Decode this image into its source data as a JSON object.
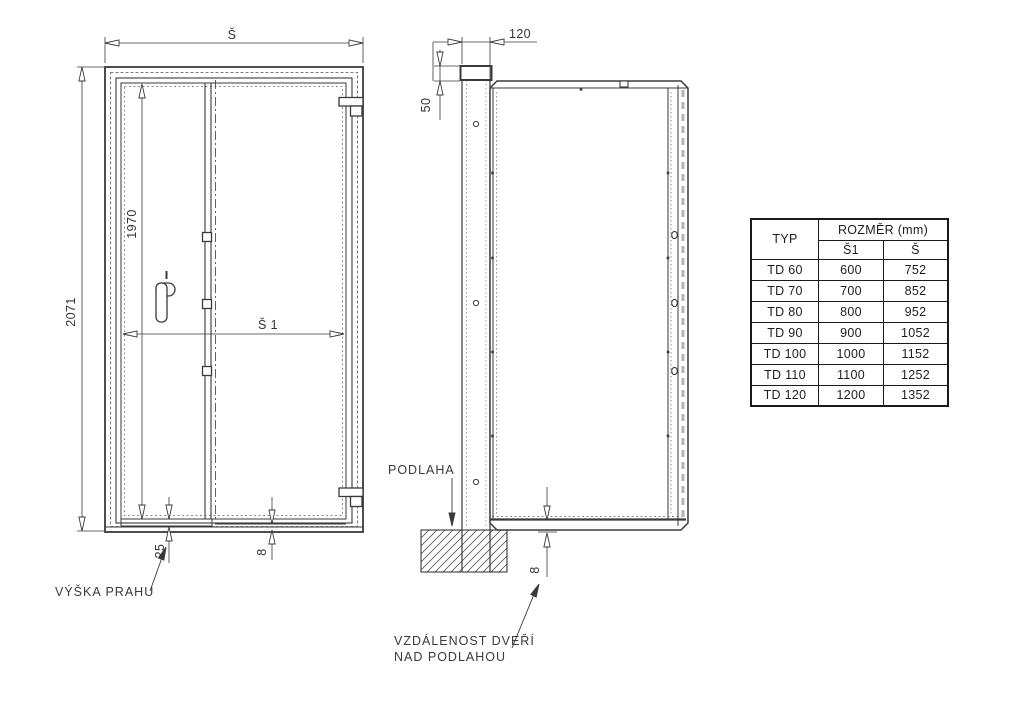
{
  "front_view": {
    "width_dim": "Š",
    "height_dim": "2071",
    "opening_height_dim": "1970",
    "opening_width_dim": "Š 1",
    "threshold_dim": "25",
    "bottom_gap_dim": "8",
    "threshold_label": "VÝŠKA PRAHU"
  },
  "side_view": {
    "frame_depth_dim": "120",
    "top_offset_dim": "50",
    "floor_gap_dim": "8",
    "floor_label": "PODLAHA",
    "gap_note_line1": "VZDÁLENOST DVEŘÍ",
    "gap_note_line2": "NAD PODLAHOU"
  },
  "size_table": {
    "col_type": "TYP",
    "col_dimension": "ROZMĚR (mm)",
    "col_s1": "Š1",
    "col_s": "Š",
    "rows": [
      {
        "type": "TD 60",
        "s1": "600",
        "s": "752"
      },
      {
        "type": "TD 70",
        "s1": "700",
        "s": "852"
      },
      {
        "type": "TD 80",
        "s1": "800",
        "s": "952"
      },
      {
        "type": "TD 90",
        "s1": "900",
        "s": "1052"
      },
      {
        "type": "TD 100",
        "s1": "1000",
        "s": "1152"
      },
      {
        "type": "TD 110",
        "s1": "1100",
        "s": "1252"
      },
      {
        "type": "TD 120",
        "s1": "1200",
        "s": "1352"
      }
    ]
  },
  "colors": {
    "line": "#3a3a3a",
    "text": "#333333",
    "background": "#ffffff"
  }
}
